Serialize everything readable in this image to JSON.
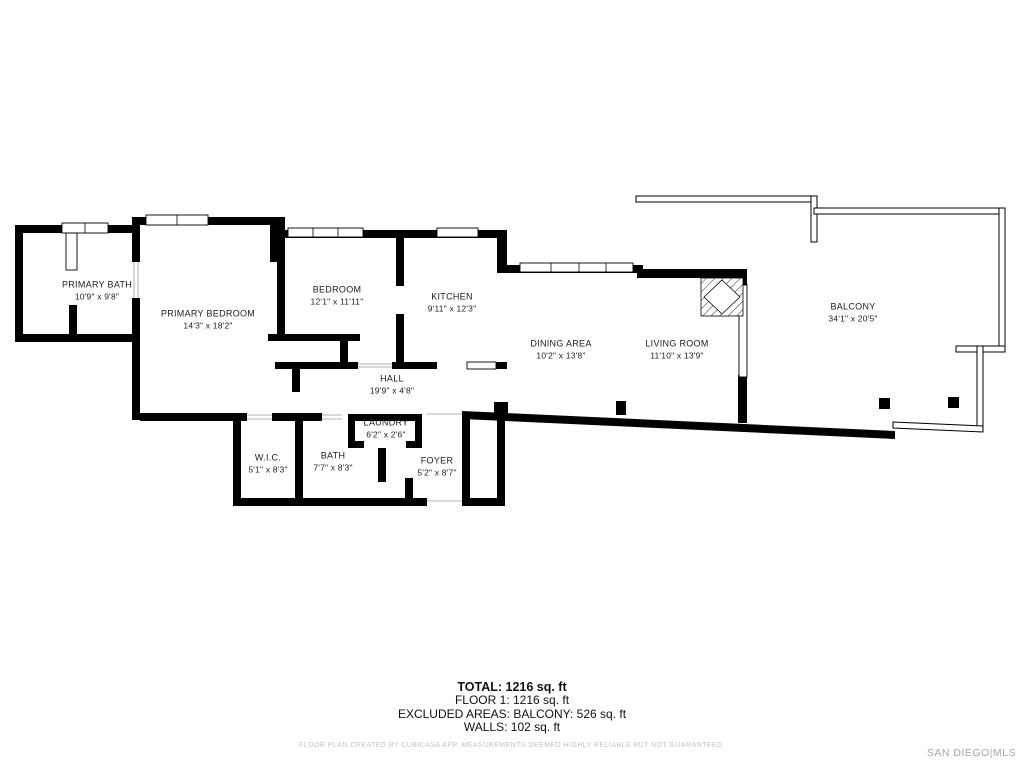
{
  "rooms": [
    {
      "name": "PRIMARY BATH",
      "dims": "10'9\" x 9'8\""
    },
    {
      "name": "PRIMARY BEDROOM",
      "dims": "14'3\" x 18'2\""
    },
    {
      "name": "BEDROOM",
      "dims": "12'1\" x 11'11\""
    },
    {
      "name": "KITCHEN",
      "dims": "9'11\" x 12'3\""
    },
    {
      "name": "DINING AREA",
      "dims": "10'2\" x 13'8\""
    },
    {
      "name": "LIVING ROOM",
      "dims": "11'10\" x 13'9\""
    },
    {
      "name": "BALCONY",
      "dims": "34'1\" x 20'5\""
    },
    {
      "name": "HALL",
      "dims": "19'9\" x 4'8\""
    },
    {
      "name": "W.I.C.",
      "dims": "5'1\" x 8'3\""
    },
    {
      "name": "BATH",
      "dims": "7'7\" x 8'3\""
    },
    {
      "name": "LAUNDRY",
      "dims": "6'2\" x 2'6\""
    },
    {
      "name": "FOYER",
      "dims": "5'2\" x 8'7\""
    }
  ],
  "summary": {
    "total": "TOTAL: 1216 sq. ft",
    "floor1": "FLOOR 1: 1216 sq. ft",
    "excluded": "EXCLUDED AREAS: BALCONY: 526 sq. ft",
    "walls": "WALLS: 102 sq. ft"
  },
  "disclaimer": "FLOOR PLAN CREATED BY CUBICASA APP. MEASUREMENTS DEEMED HIGHLY RELIABLE BUT NOT GUARANTEED.",
  "watermark": "SAN DIEGO|MLS",
  "colors": {
    "wall": "#000000",
    "background": "#ffffff",
    "disclaimer_text": "#c3c3c3",
    "watermark_text": "#a6a6a6"
  }
}
